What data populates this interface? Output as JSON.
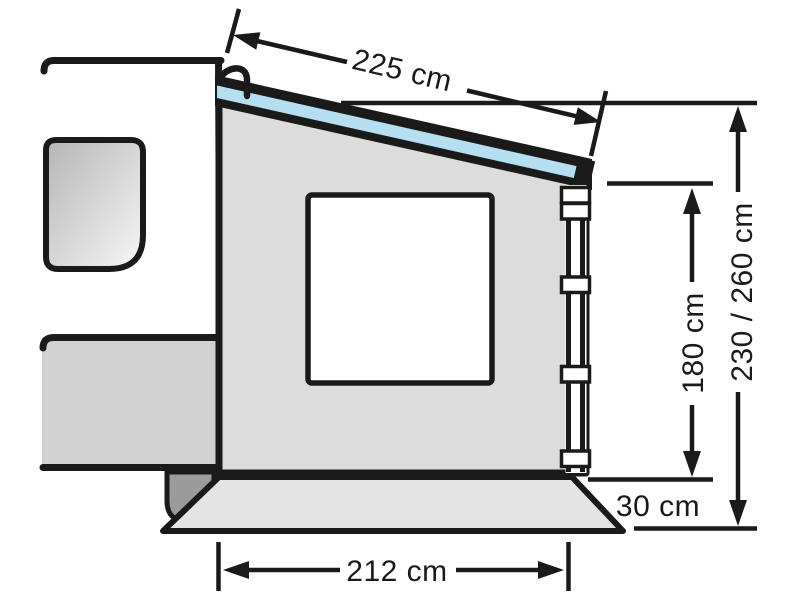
{
  "diagram": {
    "type": "technical-dimension-diagram",
    "subject": "Caravan awning side wall with window, front pole, ground skirt and dimension arrows",
    "labels": {
      "roof_depth": "225 cm",
      "wall_height": "180 cm",
      "mount_height_range": "230 / 260 cm",
      "skirt_height": "30 cm",
      "front_width": "212 cm"
    },
    "colors": {
      "outline": "#1a1a1a",
      "background": "#ffffff",
      "wall_fill": "#dcdcdc",
      "caravan_band_fill": "#d2d2d2",
      "skirt_fill": "#e4e4e4",
      "wheel_fill": "#9b9b9b",
      "roof_beading_blue": "#b5def1",
      "window_glass_dark": "#b5b5b5",
      "window_glass_light": "#f7f7f7"
    }
  }
}
